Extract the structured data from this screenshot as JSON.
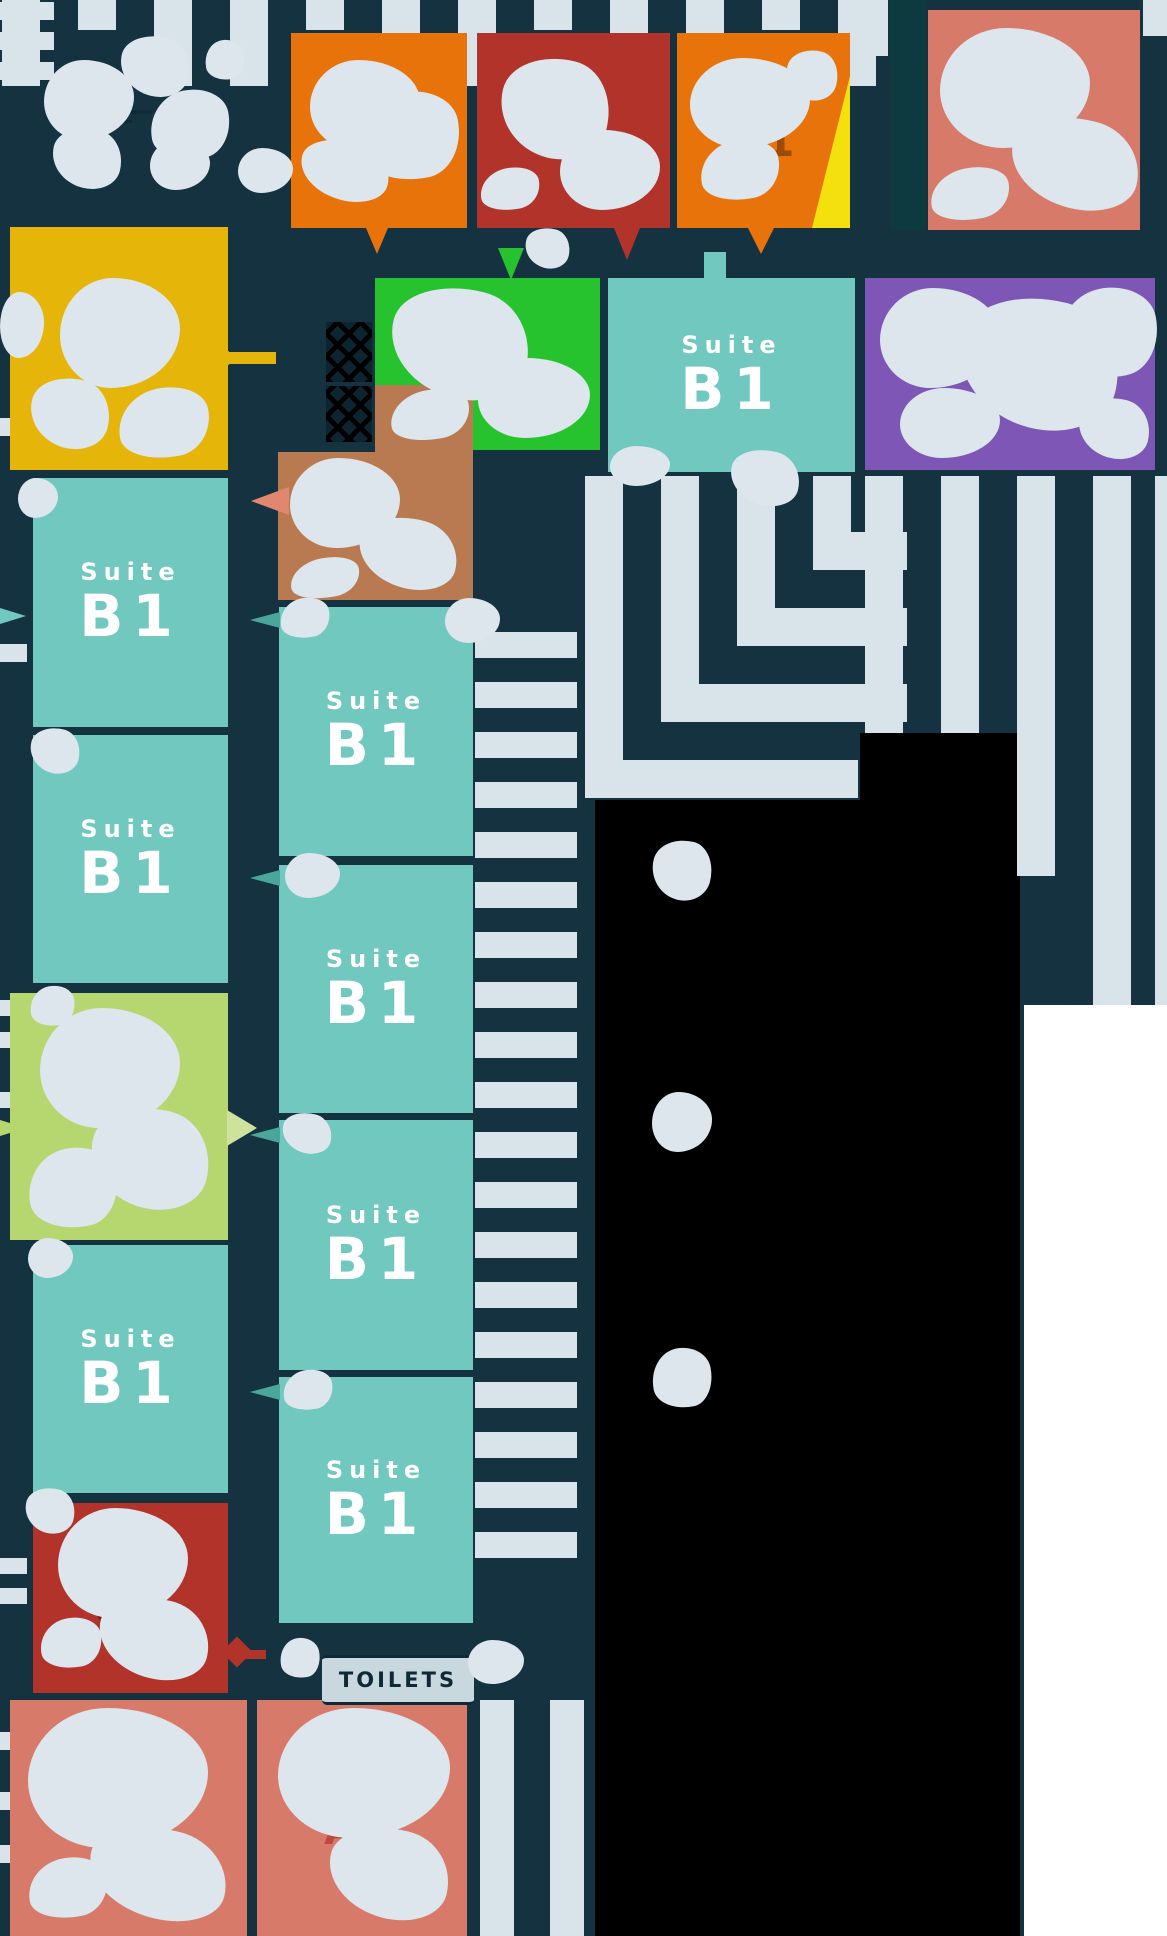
{
  "canvas": {
    "width": 1167,
    "height": 1936
  },
  "palette": {
    "background": "#143240",
    "parking_stripe": "#d9e3ea",
    "blob_overlay": "#dce6ec",
    "teal_suite": "#70c8be",
    "orange_suite": "#e8730b",
    "dark_red_suite": "#b23329",
    "salmon_suite": "#d87a69",
    "purple_suite": "#7d56b6",
    "green_suite": "#26c32f",
    "light_green_suite": "#b6d66f",
    "yellow_suite": "#e5b50a",
    "brown_suite": "#ba7a51",
    "black_zone": "#000000",
    "white_zone": "#ffffff",
    "yellow_accent_wedge": "#f4e00d"
  },
  "suites": {
    "orangeA": {
      "label": "Suite",
      "code": "V1"
    },
    "redTop": {
      "label": "Suite",
      "code": "C1"
    },
    "orangeC": {
      "label": "Suite",
      "code": "V1"
    },
    "salmonTop": {
      "label": "Suite",
      "code": "A1"
    },
    "tealTop": {
      "label": "Suite",
      "code": "B1"
    },
    "tealL1": {
      "label": "Suite",
      "code": "B1"
    },
    "tealL2": {
      "label": "Suite",
      "code": "B1"
    },
    "tealL3": {
      "label": "Suite",
      "code": "B1"
    },
    "tealM1": {
      "label": "Suite",
      "code": "B1"
    },
    "tealM2": {
      "label": "Suite",
      "code": "B1"
    },
    "tealM3": {
      "label": "Suite",
      "code": "B1"
    },
    "tealM4": {
      "label": "Suite",
      "code": "B1"
    },
    "redBottom": {
      "label": "Suite",
      "code": "C1"
    },
    "salmonA1": {
      "label": "Suite",
      "code": "A1"
    },
    "salmonA2": {
      "label": "Suite",
      "code": "A2"
    }
  },
  "amenities": {
    "toilets_label": "TOILETS"
  }
}
